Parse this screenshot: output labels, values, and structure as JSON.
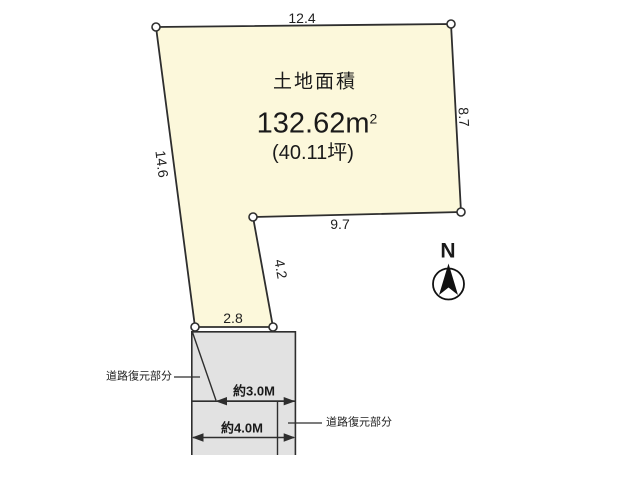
{
  "diagram": {
    "plot": {
      "title": "土地面積",
      "area_m2": "132.62m",
      "area_m2_sup": "2",
      "area_tsubo": "(40.11坪)",
      "dim_top": "12.4",
      "dim_right": "8.7",
      "dim_left": "14.6",
      "dim_mid_bottom": "9.7",
      "dim_diagonal": "4.2",
      "dim_bottom": "2.8"
    },
    "road": {
      "label_left": "道路復元部分",
      "label_right": "道路復元部分",
      "width_front": "約3.0M",
      "width_full": "約4.0M"
    },
    "compass": {
      "label": "N"
    },
    "colors": {
      "plot_fill": "#fcf8db",
      "road_fill": "#e2e2e2",
      "line": "#2e2e2e"
    }
  }
}
